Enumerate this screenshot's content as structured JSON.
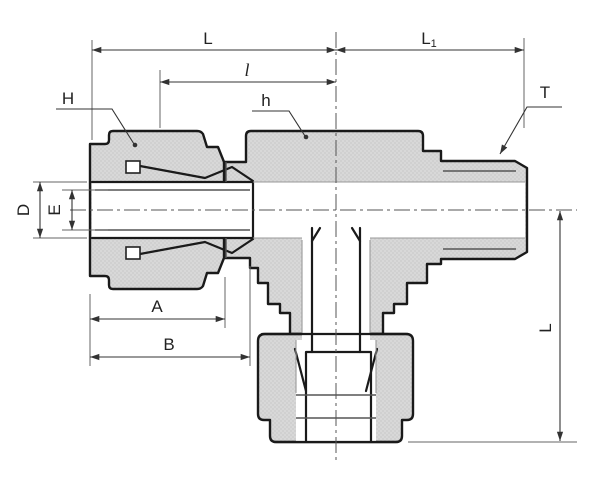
{
  "drawing": {
    "description": "Cross-section technical drawing of a male run tee tube fitting with compression nuts and male thread end"
  },
  "labels": {
    "length_L_top": "L",
    "length_L1_base": "L",
    "length_L1_sub": "1",
    "length_l_small": "l",
    "nut_H": "H",
    "hex_h": "h",
    "thread_T": "T",
    "tube_od_D": "D",
    "bore_E": "E",
    "length_A": "A",
    "length_B": "B",
    "height_L_side": "L"
  },
  "colors": {
    "background": "#ffffff",
    "outline": "#1a1a1a",
    "section_fill": "#d8d8d8",
    "section_fill_alt": "#d0d0d0",
    "dimension_line": "#333333"
  }
}
